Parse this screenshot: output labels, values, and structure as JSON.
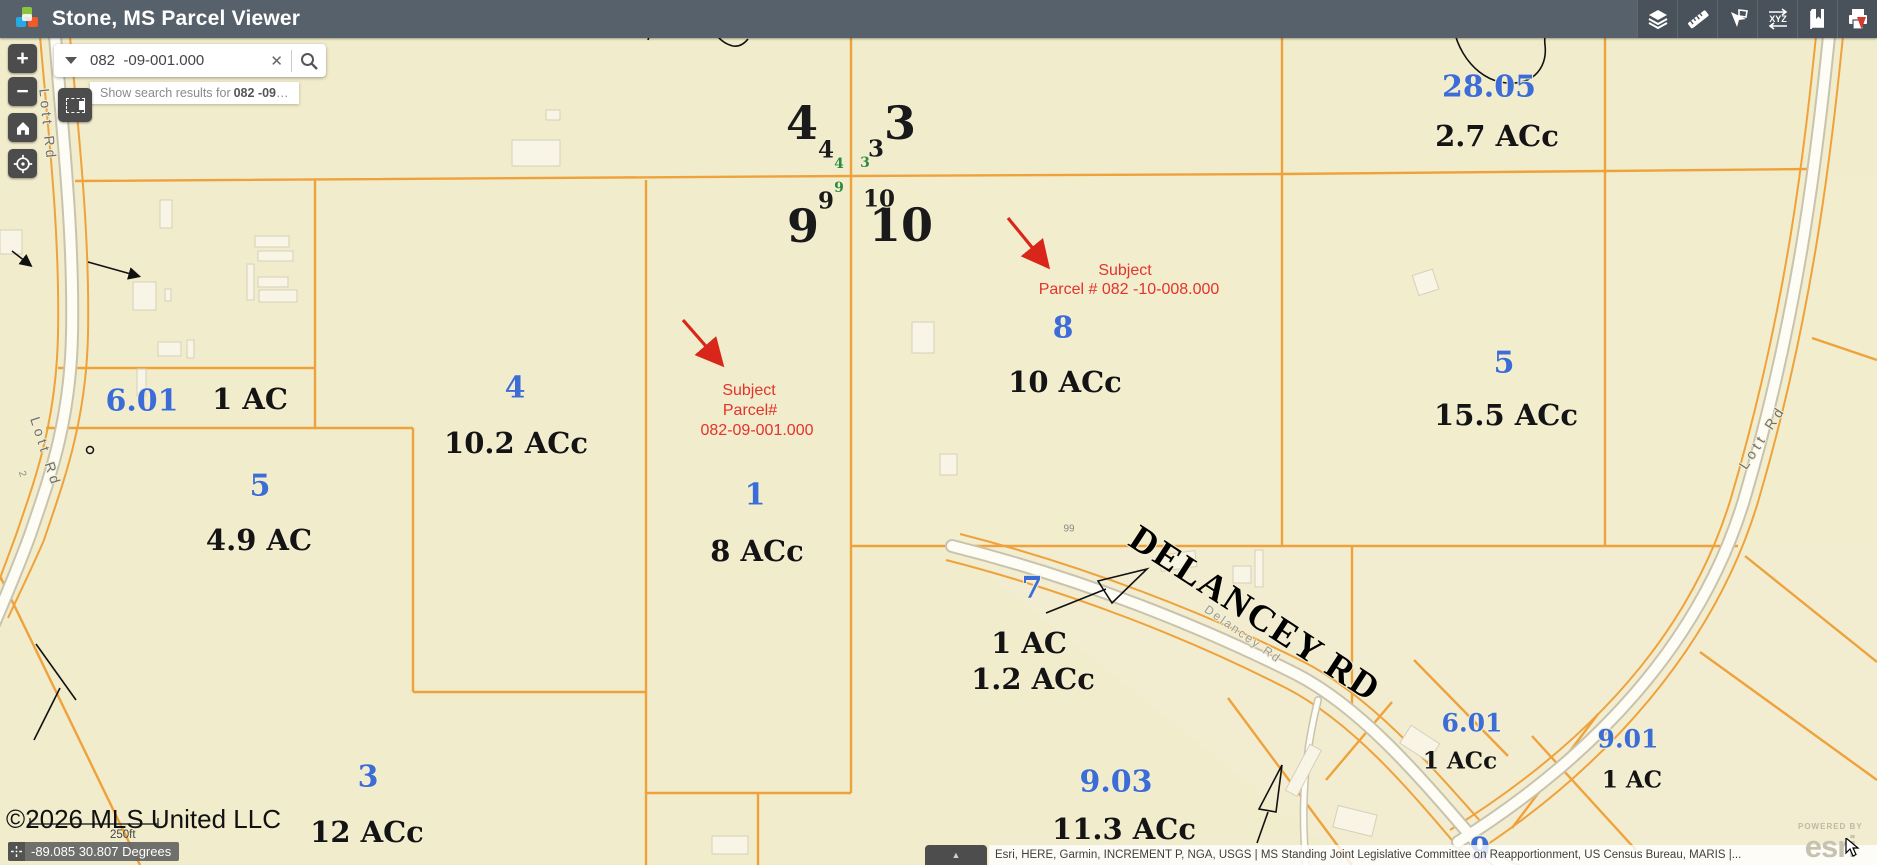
{
  "header": {
    "title": "Stone, MS Parcel Viewer",
    "toolbar_icons": [
      "layers",
      "measure",
      "sketch",
      "coordinates",
      "bookmarks",
      "print"
    ],
    "xyz_glyph": "XYZ"
  },
  "search": {
    "value": "082  -09-001.000",
    "clear_glyph": "✕",
    "suggestion_prefix": "Show search results for",
    "suggestion_term": "082 -09",
    "suggestion_suffix": "…"
  },
  "controls": {
    "zoom_in": "+",
    "zoom_out": "−"
  },
  "statusbar": {
    "copyright": "©2026 MLS United LLC",
    "scale_label": "250ft",
    "coordinates": "-89.085 30.807 Degrees",
    "tab_glyph": "▲",
    "attribution": "Esri, HERE, Garmin, INCREMENT P, NGA, USGS | MS Standing Joint Legislative Committee on Reapportionment, US Census Bureau, MARIS |..."
  },
  "watermark": {
    "powered_by": "POWERED BY",
    "brand": "esri"
  },
  "colors": {
    "header_bg": "#57616b",
    "map_bg": "#f1eccb",
    "parcel_line": "#efa23b",
    "parcel_number_blue": "#3c6cd6",
    "subject_red": "#e2342c",
    "section_green": "#2e8b3d"
  },
  "map": {
    "labels": [
      {
        "t": "4",
        "x": 802,
        "y": 123,
        "cls": "sec-xl"
      },
      {
        "t": "3",
        "x": 900,
        "y": 123,
        "cls": "sec-xl"
      },
      {
        "t": "9",
        "x": 803,
        "y": 226,
        "cls": "sec-xl"
      },
      {
        "t": "10",
        "x": 901,
        "y": 225,
        "cls": "sec-xl"
      },
      {
        "t": "4",
        "x": 826,
        "y": 150,
        "cls": "sec-md"
      },
      {
        "t": "3",
        "x": 876,
        "y": 149,
        "cls": "sec-md"
      },
      {
        "t": "9",
        "x": 826,
        "y": 201,
        "cls": "sec-md"
      },
      {
        "t": "10",
        "x": 879,
        "y": 199,
        "cls": "sec-md"
      },
      {
        "t": "4",
        "x": 839,
        "y": 164,
        "cls": "sec-sm"
      },
      {
        "t": "3",
        "x": 865,
        "y": 163,
        "cls": "sec-sm"
      },
      {
        "t": "9",
        "x": 839,
        "y": 188,
        "cls": "sec-sm"
      },
      {
        "t": "28.05",
        "x": 1489,
        "y": 87,
        "cls": "pnum"
      },
      {
        "t": "2.7 ACc",
        "x": 1497,
        "y": 136,
        "cls": "acre"
      },
      {
        "t": "6.01",
        "x": 142,
        "y": 401,
        "cls": "pnum"
      },
      {
        "t": "1 AC",
        "x": 250,
        "y": 399,
        "cls": "acre"
      },
      {
        "t": "4",
        "x": 515,
        "y": 388,
        "cls": "pnum"
      },
      {
        "t": "10.2 ACc",
        "x": 516,
        "y": 443,
        "cls": "acre"
      },
      {
        "t": "5",
        "x": 260,
        "y": 486,
        "cls": "pnum"
      },
      {
        "t": "4.9 AC",
        "x": 259,
        "y": 540,
        "cls": "acre"
      },
      {
        "t": "1",
        "x": 755,
        "y": 495,
        "cls": "pnum"
      },
      {
        "t": "8 ACc",
        "x": 757,
        "y": 551,
        "cls": "acre"
      },
      {
        "t": "8",
        "x": 1063,
        "y": 328,
        "cls": "pnum"
      },
      {
        "t": "10 ACc",
        "x": 1065,
        "y": 382,
        "cls": "acre"
      },
      {
        "t": "5",
        "x": 1504,
        "y": 363,
        "cls": "pnum"
      },
      {
        "t": "15.5 ACc",
        "x": 1506,
        "y": 415,
        "cls": "acre"
      },
      {
        "t": "7",
        "x": 1032,
        "y": 588,
        "cls": "pnum"
      },
      {
        "t": "1 AC",
        "x": 1029,
        "y": 643,
        "cls": "acre"
      },
      {
        "t": "1.2 ACc",
        "x": 1033,
        "y": 679,
        "cls": "acre"
      },
      {
        "t": "3",
        "x": 368,
        "y": 777,
        "cls": "pnum"
      },
      {
        "t": "12 ACc",
        "x": 367,
        "y": 832,
        "cls": "acre"
      },
      {
        "t": "9.03",
        "x": 1116,
        "y": 782,
        "cls": "pnum"
      },
      {
        "t": "11.3 ACc",
        "x": 1124,
        "y": 829,
        "cls": "acre"
      },
      {
        "t": "6.01",
        "x": 1472,
        "y": 723,
        "cls": "pnum-sm"
      },
      {
        "t": "1 ACc",
        "x": 1460,
        "y": 761,
        "cls": "acre-sm"
      },
      {
        "t": "9.01",
        "x": 1628,
        "y": 739,
        "cls": "pnum-sm"
      },
      {
        "t": "1 AC",
        "x": 1632,
        "y": 780,
        "cls": "acre-sm"
      },
      {
        "t": "9",
        "x": 1480,
        "y": 849,
        "cls": "pnum"
      },
      {
        "t": "Subject",
        "x": 1125,
        "y": 271,
        "cls": "red-note"
      },
      {
        "t": "Parcel # 082 -10-008.000",
        "x": 1129,
        "y": 290,
        "cls": "red-note"
      },
      {
        "t": "Subject",
        "x": 749,
        "y": 391,
        "cls": "red-note"
      },
      {
        "t": "Parcel#",
        "x": 750,
        "y": 411,
        "cls": "red-note"
      },
      {
        "t": "082-09-001.000",
        "x": 757,
        "y": 431,
        "cls": "red-note"
      },
      {
        "t": "Lott Rd",
        "x": 48,
        "y": 125,
        "cls": "road",
        "rot": 84
      },
      {
        "t": "Lott Rd",
        "x": 46,
        "y": 452,
        "cls": "road",
        "rot": 72
      },
      {
        "t": "2",
        "x": 22,
        "y": 474,
        "cls": "tiny",
        "rot": 72
      },
      {
        "t": "Lott Rd",
        "x": 1762,
        "y": 437,
        "cls": "road",
        "rot": -57
      },
      {
        "t": "DELANCEY RD",
        "x": 1255,
        "y": 614,
        "cls": "road-big",
        "rot": 33
      },
      {
        "t": "Delancey Rd",
        "x": 1243,
        "y": 634,
        "cls": "road-sm",
        "rot": 35
      },
      {
        "t": "99",
        "x": 1069,
        "y": 529,
        "cls": "tiny"
      }
    ]
  }
}
